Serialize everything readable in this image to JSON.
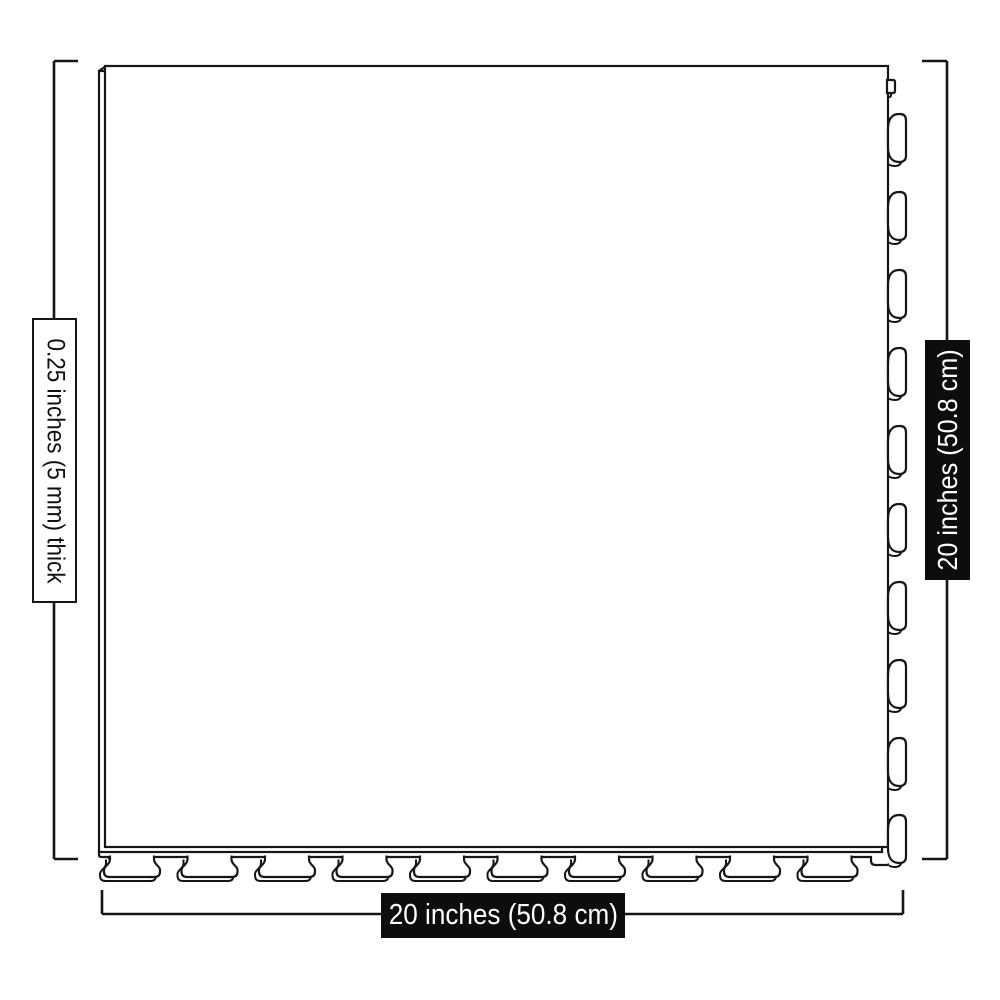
{
  "figure": {
    "type": "product-dimension-diagram",
    "labels": {
      "thickness": "0.25 inches (5 mm) thick",
      "height": "20 inches (50.8 cm)",
      "width": "20 inches (50.8 cm)"
    },
    "tile": {
      "bottom_tab_count": 10,
      "right_slot_count": 10
    },
    "colors": {
      "background": "#ffffff",
      "line": "#161616",
      "label_background": "#0d0d0d",
      "label_text": "#ffffff"
    }
  }
}
